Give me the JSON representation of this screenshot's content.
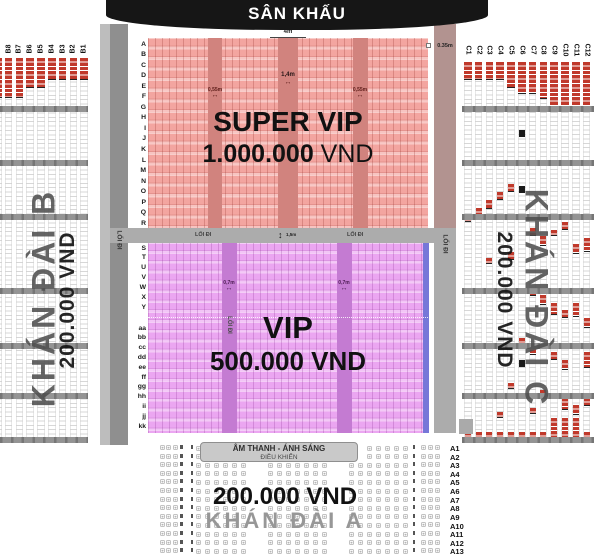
{
  "stage": {
    "label": "SÂN KHẤU"
  },
  "icons": {
    "h_arrow": "↔",
    "v_arrow": "↕"
  },
  "super_vip": {
    "title": "SUPER VIP",
    "price": "1.000.000",
    "currency": " VND",
    "row_labels": [
      "A",
      "B",
      "C",
      "D",
      "E",
      "F",
      "G",
      "H",
      "I",
      "J",
      "K",
      "L",
      "M",
      "N",
      "O",
      "P",
      "Q",
      "R"
    ],
    "dim_top": "4m",
    "dim_right": "0.35m",
    "dim_aisle_small": "0,55m",
    "dim_aisle_mid": "1,4m"
  },
  "vip": {
    "title": "VIP",
    "price": "500.000 VND",
    "rows_upper": [
      "S",
      "T",
      "U",
      "V",
      "W",
      "X",
      "Y"
    ],
    "rows_lower": [
      "aa",
      "bb",
      "cc",
      "dd",
      "ee",
      "ff",
      "gg",
      "hh",
      "ii",
      "jj",
      "kk"
    ],
    "aisle_label": "LỐI ĐI",
    "dim_aisle": "0,7m"
  },
  "walkway": {
    "label_left": "LỐI ĐI",
    "label_right": "LỐI ĐI",
    "dim": "1,5m",
    "side_left": "LỐI ĐI",
    "side_right": "LỐI ĐI"
  },
  "stand_b": {
    "name": "KHÁN ĐÀI B",
    "price": "200.000 VND",
    "columns": [
      "B8",
      "B7",
      "B6",
      "B5",
      "B4",
      "B3",
      "B2",
      "B1"
    ],
    "red_top_heights": [
      40,
      40,
      30,
      30,
      22,
      22,
      22,
      22
    ],
    "edge_red_height": 40
  },
  "stand_c": {
    "name": "KHÁN ĐÀI C",
    "price": "200.000 VND",
    "columns": [
      "C1",
      "C2",
      "C3",
      "C4",
      "C5",
      "C6",
      "C7",
      "C8",
      "C9",
      "C10",
      "C11",
      "C12"
    ],
    "red_top_heights": [
      18,
      18,
      18,
      18,
      26,
      32,
      32,
      37,
      45,
      45,
      45,
      45
    ],
    "sold_marks": [
      [
        1,
        208,
        8
      ],
      [
        2,
        200,
        9
      ],
      [
        3,
        192,
        8
      ],
      [
        4,
        184,
        8
      ],
      [
        0,
        216,
        6
      ],
      [
        6,
        228,
        8
      ],
      [
        7,
        236,
        10
      ],
      [
        8,
        230,
        6
      ],
      [
        9,
        222,
        8
      ],
      [
        10,
        244,
        10
      ],
      [
        11,
        238,
        14
      ],
      [
        2,
        258,
        6
      ],
      [
        4,
        252,
        8
      ],
      [
        6,
        288,
        8
      ],
      [
        7,
        295,
        10
      ],
      [
        8,
        303,
        12
      ],
      [
        9,
        310,
        8
      ],
      [
        10,
        303,
        14
      ],
      [
        11,
        318,
        10
      ],
      [
        5,
        338,
        6
      ],
      [
        6,
        345,
        10
      ],
      [
        8,
        352,
        8
      ],
      [
        9,
        360,
        10
      ],
      [
        11,
        352,
        16
      ],
      [
        4,
        383,
        6
      ],
      [
        7,
        390,
        8
      ],
      [
        9,
        398,
        12
      ],
      [
        10,
        405,
        10
      ],
      [
        11,
        398,
        8
      ],
      [
        3,
        412,
        6
      ],
      [
        6,
        408,
        6
      ]
    ],
    "black_marks": [
      [
        5,
        130
      ],
      [
        5,
        186
      ],
      [
        5,
        360
      ]
    ],
    "bottom_red_tall_cols": [
      8,
      9,
      10
    ]
  },
  "stand_a": {
    "name": "KHÁN ĐÀI A",
    "price": "200.000 VND",
    "booth_line1": "ÂM THANH - ÁNH SÁNG",
    "booth_line2": "ĐIỀU KHIỂN",
    "row_labels": [
      "A1",
      "A2",
      "A3",
      "A4",
      "A5",
      "A6",
      "A7",
      "A8",
      "A9",
      "A10",
      "A11",
      "A12",
      "A13"
    ]
  },
  "colors": {
    "stage_bg": "#161616",
    "svip_bg": "#F3A5A0",
    "svip_aisle": "#D1837E",
    "vip_bg": "#EBA6F1",
    "vip_aisle": "#C47BD2",
    "vip_edge": "#7677D8",
    "sold_red": "#C0392B",
    "walkway_gray": "#ACACAC",
    "stand_text_gray": "#4F4F4F"
  }
}
